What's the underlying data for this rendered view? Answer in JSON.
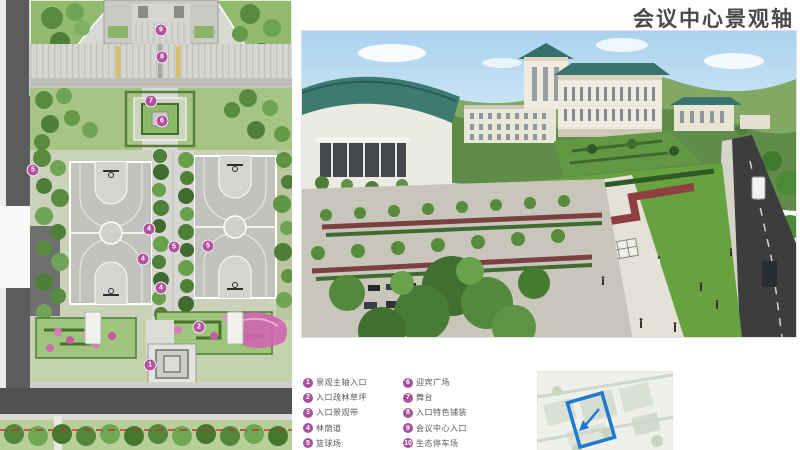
{
  "header": {
    "title": "会议中心景观轴"
  },
  "colors": {
    "marker": "#b4529f",
    "legend_badge": "#a8509c",
    "keymap_highlight": "#1f7ad0",
    "roof_teal": "#38726c",
    "hedge_red": "#8e4040",
    "flower_pink": "#d473b5"
  },
  "plan": {
    "markers": [
      {
        "num": "9",
        "x": 161,
        "y": 30
      },
      {
        "num": "8",
        "x": 162,
        "y": 57
      },
      {
        "num": "7",
        "x": 151,
        "y": 101
      },
      {
        "num": "6",
        "x": 162,
        "y": 121
      },
      {
        "num": "5",
        "x": 33,
        "y": 170
      },
      {
        "num": "4",
        "x": 149,
        "y": 229
      },
      {
        "num": "5",
        "x": 174,
        "y": 247
      },
      {
        "num": "5",
        "x": 208,
        "y": 246
      },
      {
        "num": "4",
        "x": 143,
        "y": 259
      },
      {
        "num": "4",
        "x": 161,
        "y": 288
      },
      {
        "num": "2",
        "x": 199,
        "y": 327
      },
      {
        "num": "1",
        "x": 150,
        "y": 365
      }
    ]
  },
  "legend": {
    "items": [
      {
        "num": "1",
        "label": "景观主轴入口"
      },
      {
        "num": "2",
        "label": "入口疏林草坪"
      },
      {
        "num": "3",
        "label": "入口景观带"
      },
      {
        "num": "4",
        "label": "林荫道"
      },
      {
        "num": "5",
        "label": "篮球场"
      },
      {
        "num": "6",
        "label": "迎宾广场"
      },
      {
        "num": "7",
        "label": "舞台"
      },
      {
        "num": "8",
        "label": "入口特色铺装"
      },
      {
        "num": "9",
        "label": "会议中心入口"
      },
      {
        "num": "10",
        "label": "生态停车场"
      }
    ]
  }
}
